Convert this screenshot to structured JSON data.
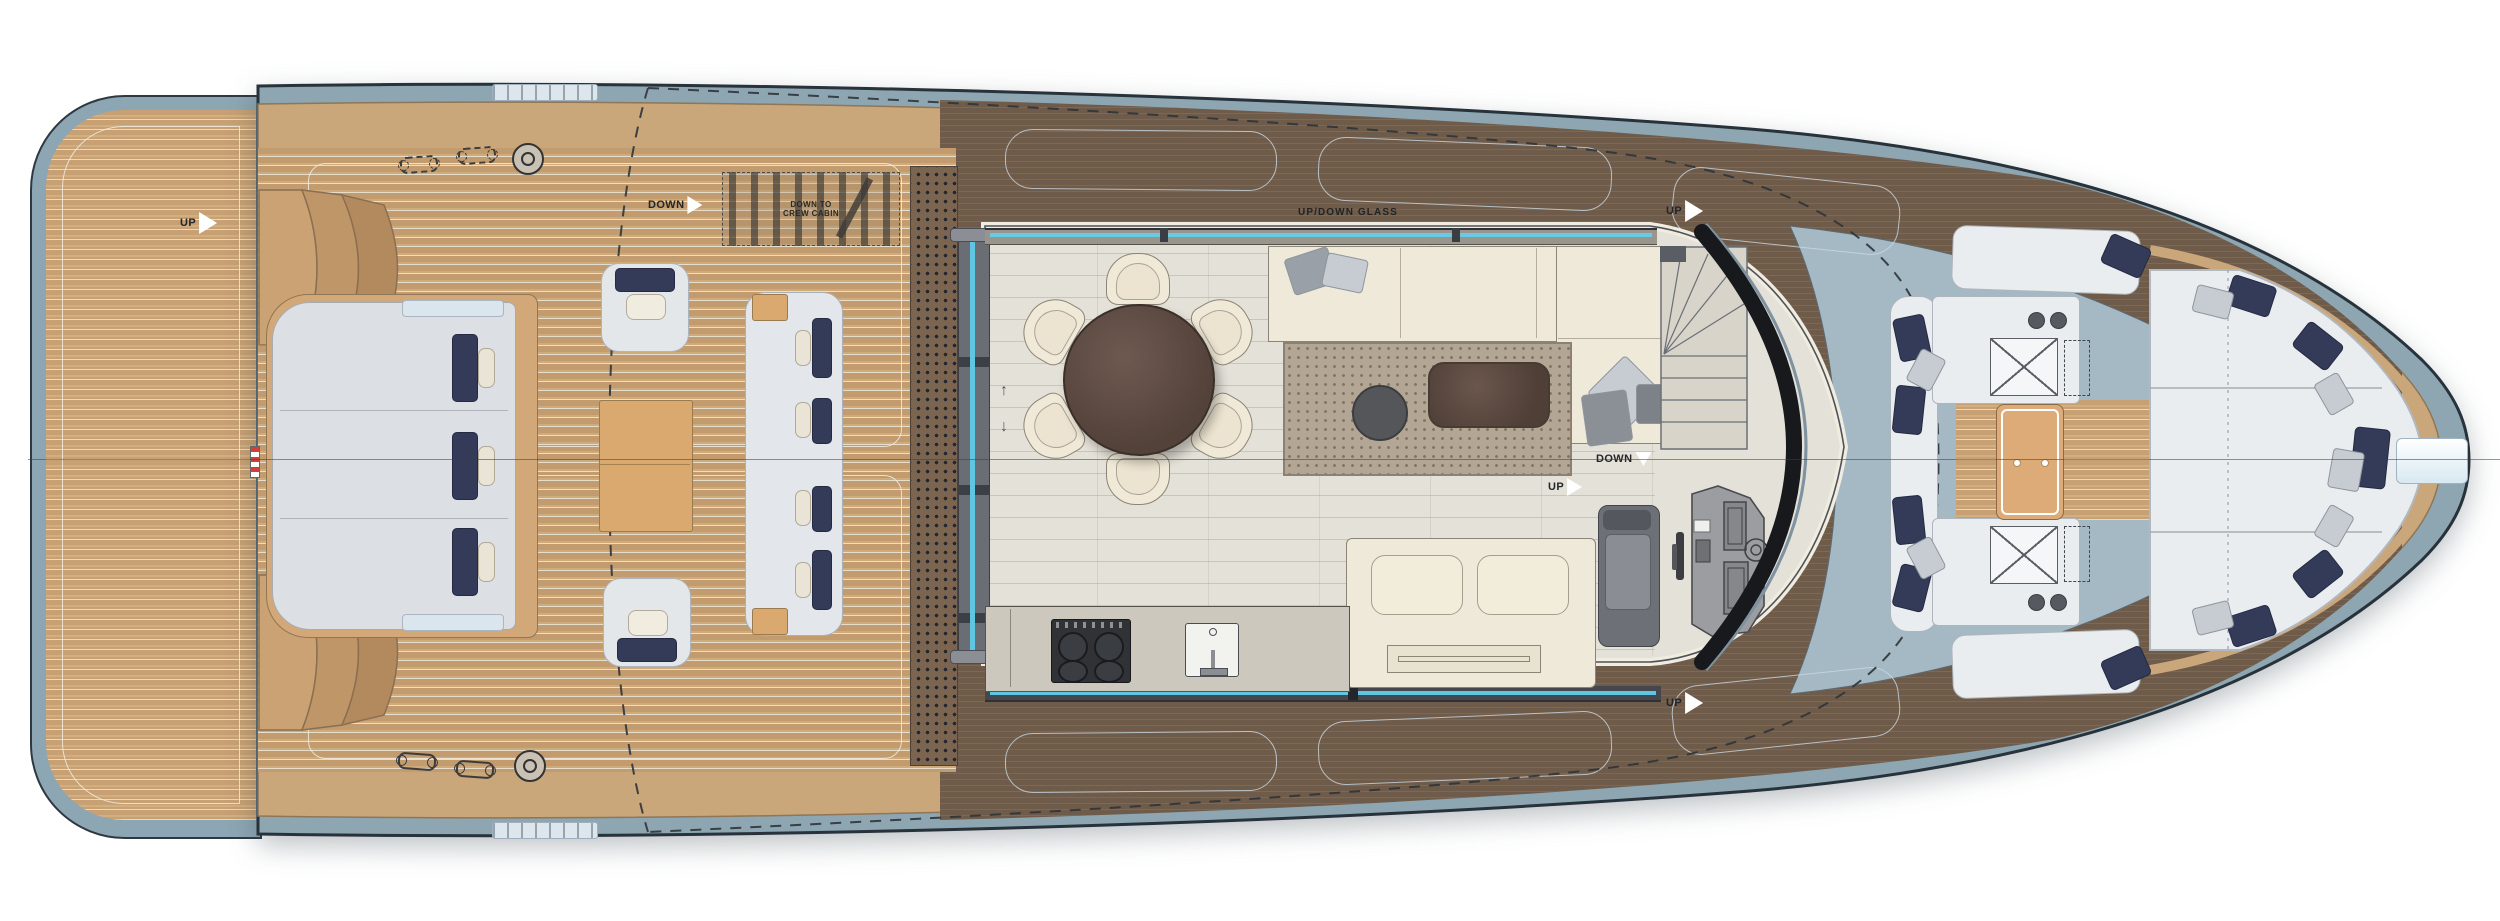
{
  "plan": {
    "title": "Motor yacht main deck arrangement plan",
    "labels": {
      "up": "UP",
      "down": "DOWN",
      "down_to_crew_cabin": "DOWN TO CREW CABIN",
      "up_down_glass": "UP/DOWN GLASS",
      "door_arrow_up": "↑",
      "door_arrow_down": "↓"
    },
    "colors": {
      "hull_bulwark": "#8DA6B2",
      "bow_deck": "#A4B9C4",
      "teak_deck": "#C9A77A",
      "walkway": "#6F5B49",
      "salon_floor": "#E4E1D8",
      "upholstery_cream": "#EFE9DA",
      "upholstery_white": "#EAEDF0",
      "pillow_navy": "#343B59",
      "glass_blue": "#5FC6E2",
      "windshield": "#17191D",
      "dining_table": "#5D4A41",
      "rug": "#B3A695"
    }
  }
}
